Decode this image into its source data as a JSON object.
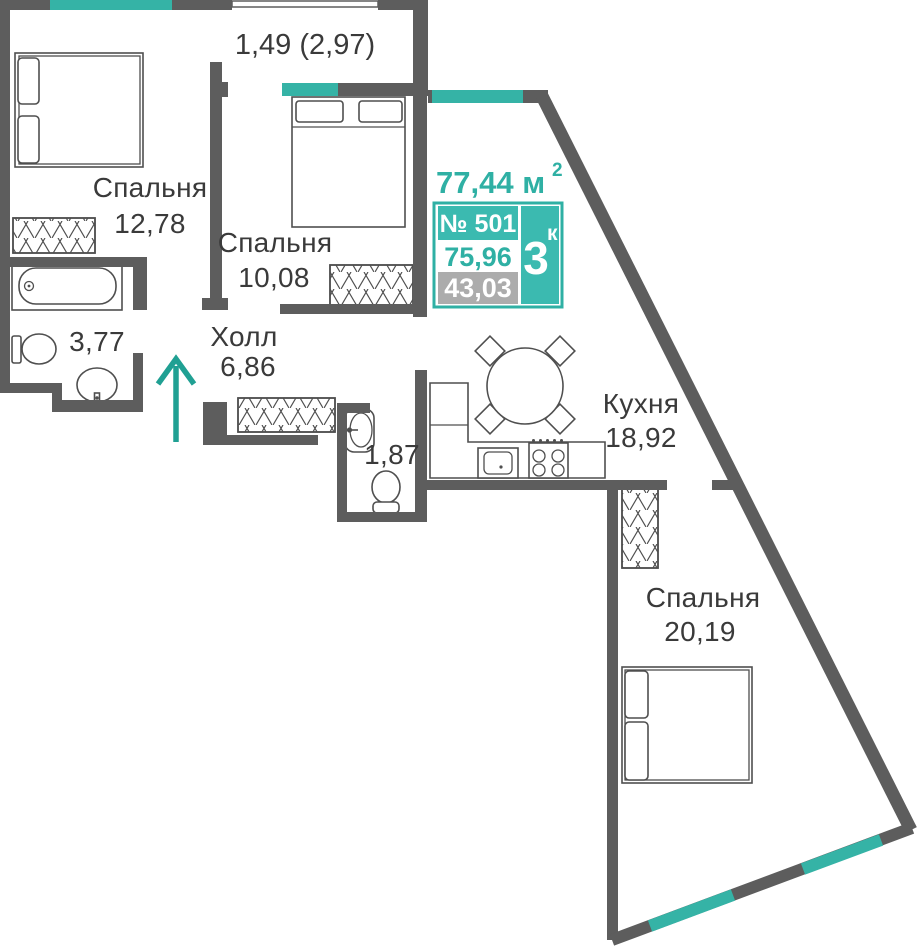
{
  "plan": {
    "labels": {
      "balcony_area": "1,49 (2,97)",
      "bedroom1_name": "Спальня",
      "bedroom1_area": "12,78",
      "bedroom2_name": "Спальня",
      "bedroom2_area": "10,08",
      "hall_name": "Холл",
      "hall_area": "6,86",
      "bathroom_area": "3,77",
      "wc_area": "1,87",
      "kitchen_name": "Кухня",
      "kitchen_area": "18,92",
      "bedroom3_name": "Спальня",
      "bedroom3_area": "20,19"
    },
    "info_box": {
      "total_area": "77,44 м",
      "total_area_sup": "2",
      "apartment_number": "№ 501",
      "rooms_count": "3",
      "rooms_count_sup": "к",
      "area_secondary_1": "75,96",
      "area_secondary_2": "43,03"
    },
    "colors": {
      "accent_teal": "#2fb0a4",
      "window_teal": "#35b3a6",
      "arrow_teal": "#20a093",
      "box_fill_teal": "#3bbab0",
      "wall_gray": "#5d5d5d",
      "secondary_box_gray": "#acacac",
      "text_dark": "#3a3a3a"
    }
  }
}
